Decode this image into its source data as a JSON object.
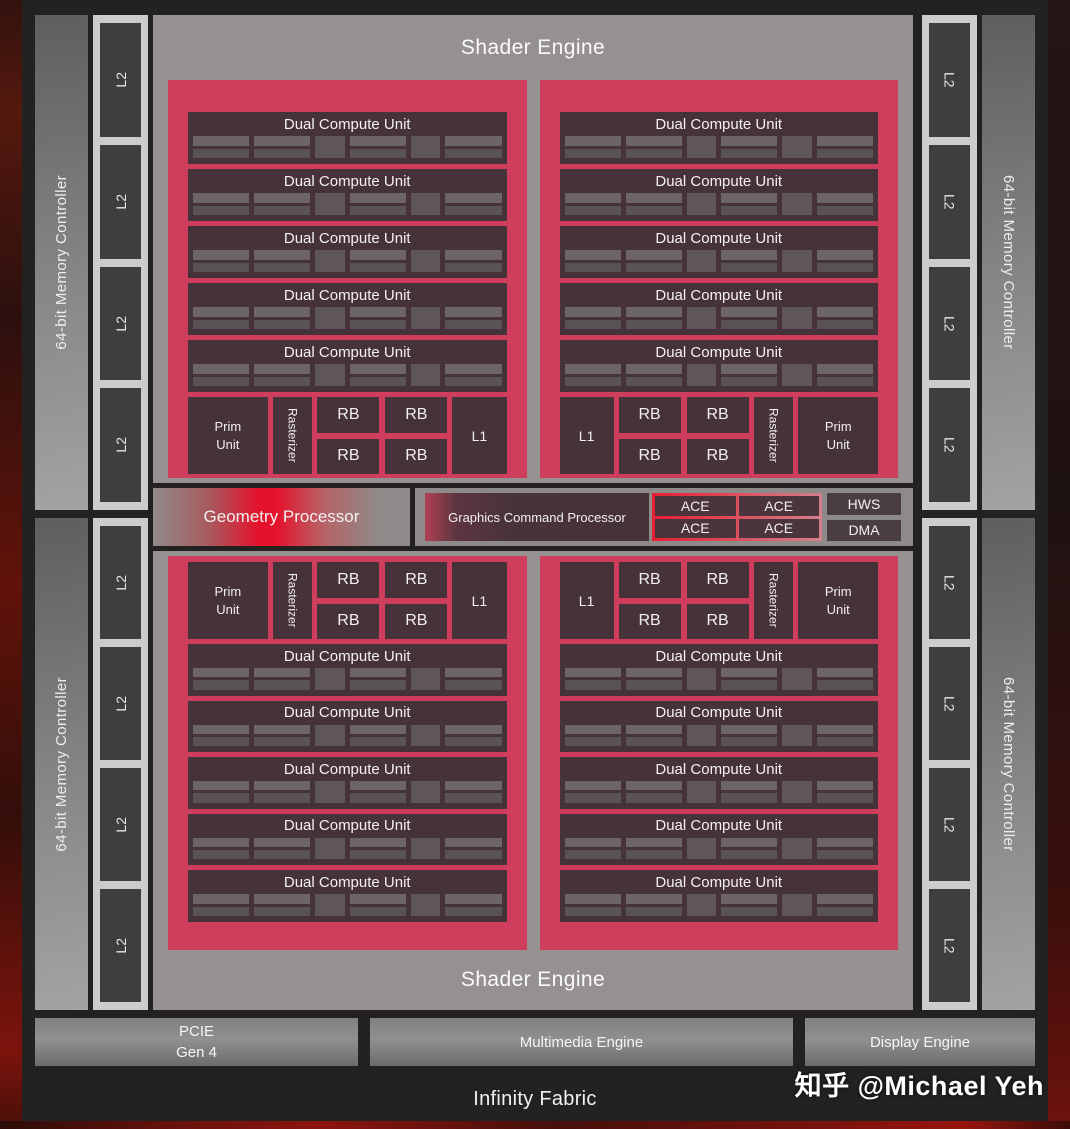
{
  "labels": {
    "shader_engine": "Shader Engine",
    "dual_compute_unit": "Dual Compute Unit",
    "memory_controller": "64-bit Memory Controller",
    "l2": "L2",
    "l1": "L1",
    "rb": "RB",
    "prim_unit": "Prim Unit",
    "rasterizer": "Rasterizer",
    "geometry_processor": "Geometry Processor",
    "graphics_command_processor": "Graphics Command Processor",
    "ace": "ACE",
    "hws": "HWS",
    "dma": "DMA",
    "pcie_line1": "PCIE",
    "pcie_line2": "Gen 4",
    "multimedia_engine": "Multimedia Engine",
    "display_engine": "Display Engine",
    "infinity_fabric": "Infinity Fabric"
  },
  "watermark": "知乎 @Michael Yeh",
  "structure": {
    "shader_engines": 2,
    "shader_arrays_per_engine": 2,
    "dual_compute_units_per_array": 5,
    "memory_controllers": 4,
    "l2_columns": 4,
    "l2_blocks_per_column": 4,
    "rb_blocks_per_array": 4,
    "ace_blocks": 4
  },
  "colors": {
    "board_background": "#242121",
    "shader_array_red": "#cf3d5d",
    "accent_red": "#e5122c",
    "block_dark": "#463239",
    "container_gray": "#959191",
    "l2_strip_gray": "#cecccb",
    "edge_red_brown": "#6e120c"
  }
}
